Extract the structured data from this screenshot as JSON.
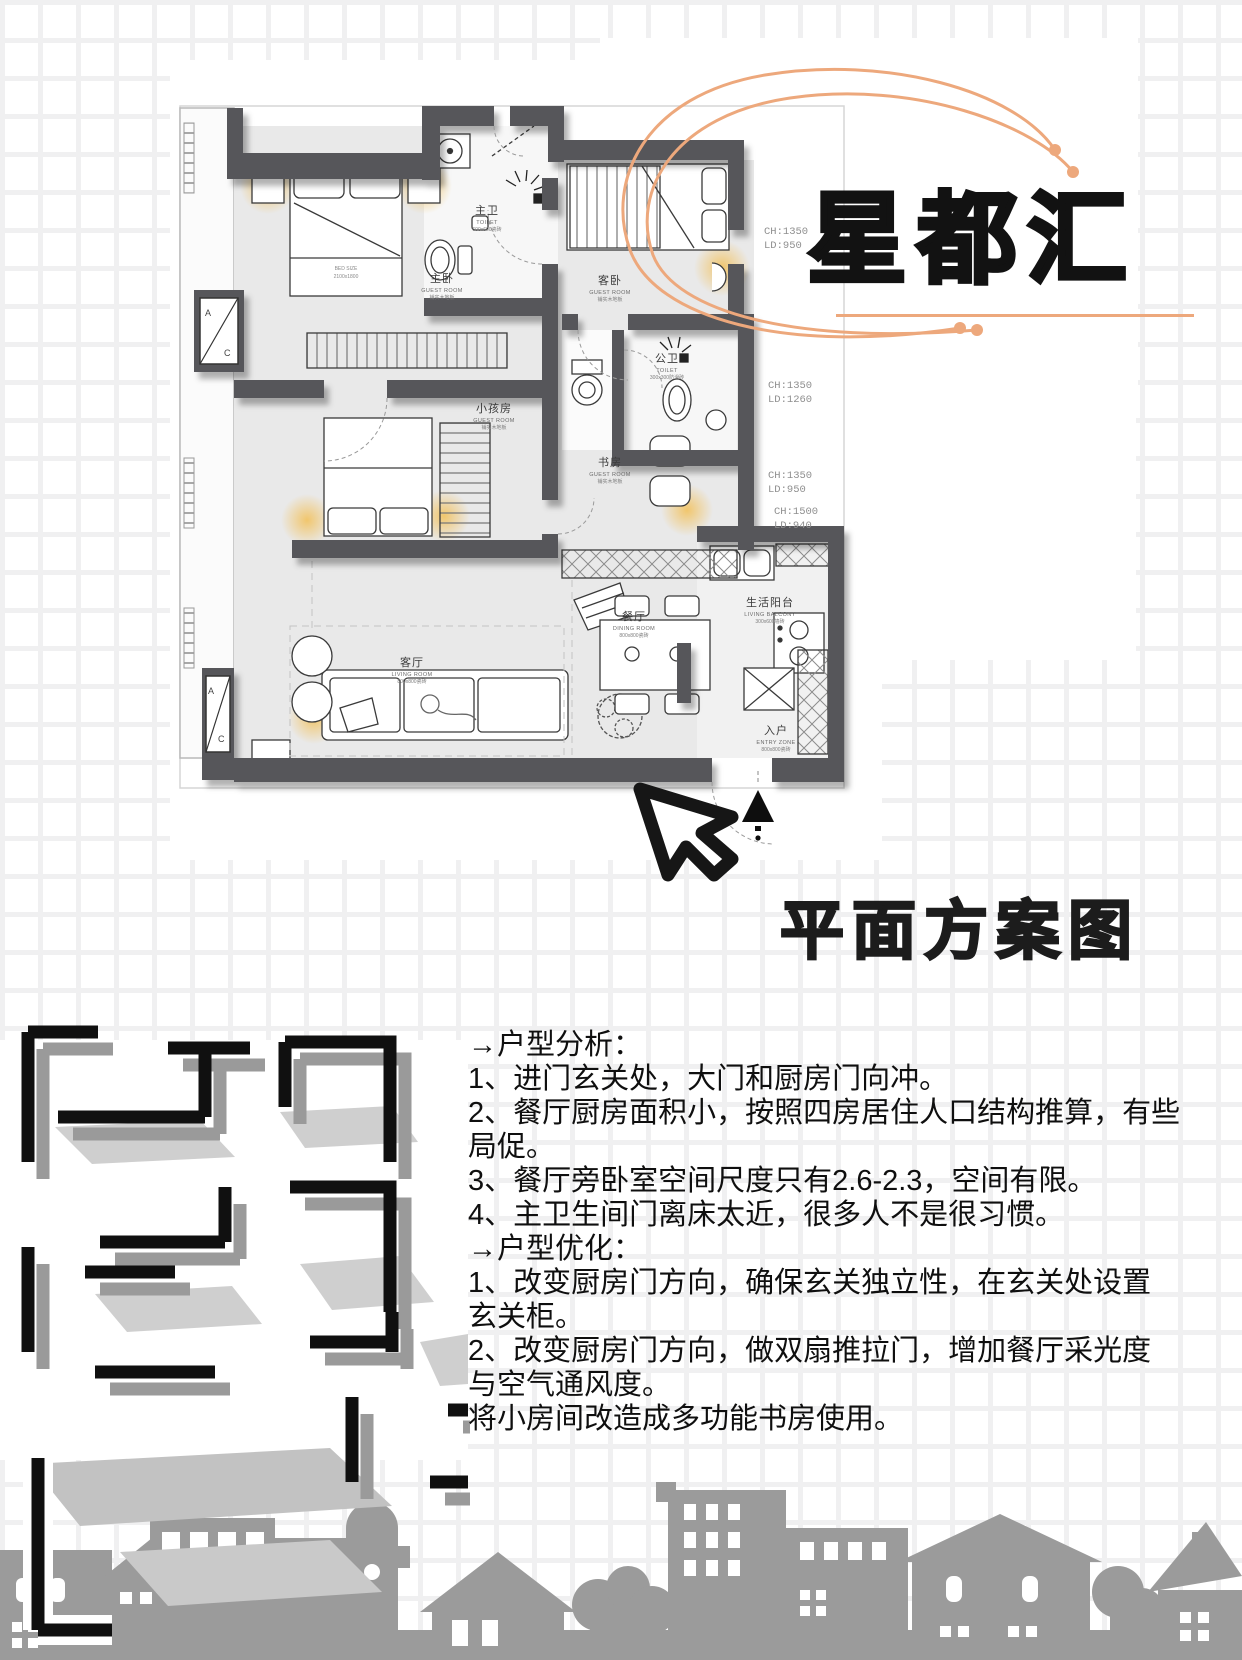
{
  "title": {
    "text": "星都汇"
  },
  "plan_heading": {
    "text": "平面方案图"
  },
  "analysis": {
    "lines": [
      "→户型分析：",
      "1、进门玄关处，大门和厨房门向冲。",
      "2、餐厅厨房面积小，按照四房居住人口结构推算，有些",
      "局促。",
      "3、餐厅旁卧室空间尺度只有2.6-2.3，空间有限。",
      "4、主卫生间门离床太近，很多人不是很习惯。",
      "→户型优化：",
      "1、改变厨房门方向，确保玄关独立性，在玄关处设置",
      "玄关柜。",
      "2、改变厨房门方向，做双扇推拉门，增加餐厅采光度",
      "与空气通风度。",
      "将小房间改造成多功能书房使用。"
    ]
  },
  "floor_plan": {
    "rooms": {
      "master_bedroom": {
        "zh": "主卧",
        "en": "GUEST ROOM",
        "sub": "铺实木地板"
      },
      "master_bath": {
        "zh": "主卫",
        "en": "TOILET",
        "sub": "600x600瓷砖"
      },
      "guest_bedroom": {
        "zh": "客卧",
        "en": "GUEST ROOM",
        "sub": "铺实木地板"
      },
      "public_bath": {
        "zh": "公卫",
        "en": "TOILET",
        "sub": "300x300防滑砖"
      },
      "kids_room": {
        "zh": "小孩房",
        "en": "GUEST ROOM",
        "sub": "铺实木地板"
      },
      "study": {
        "zh": "书房",
        "en": "GUEST ROOM",
        "sub": "铺实木地板"
      },
      "living_room": {
        "zh": "客厅",
        "en": "LIVING ROOM",
        "sub": "800x800瓷砖"
      },
      "dining_room": {
        "zh": "餐厅",
        "en": "DINING ROOM",
        "sub": "800x800瓷砖"
      },
      "kitchen": {
        "zh": "生活阳台",
        "en": "LIVING BALCONY",
        "sub": "300x600墙砖"
      },
      "entry": {
        "zh": "入户",
        "en": "ENTRY ZONE",
        "sub": "800x800瓷砖"
      }
    },
    "bed_label": {
      "line1": "BED SIZE",
      "line2": "2100x1800"
    },
    "annotations": [
      {
        "ch": "CH:1350",
        "ld": "LD:950"
      },
      {
        "ch": "CH:1350",
        "ld": "LD:1260"
      },
      {
        "ch": "CH:1350",
        "ld": "LD:950"
      },
      {
        "ch": "CH:1500",
        "ld": "LD:940"
      }
    ],
    "ac_unit": {
      "a": "A",
      "c": "C"
    }
  },
  "colors": {
    "accent_orange": "#eda87c",
    "wall_gray": "#57575a",
    "glow_yellow": "#f2c25f",
    "skyline_gray": "#9b9b9b",
    "ink": "#121212"
  }
}
